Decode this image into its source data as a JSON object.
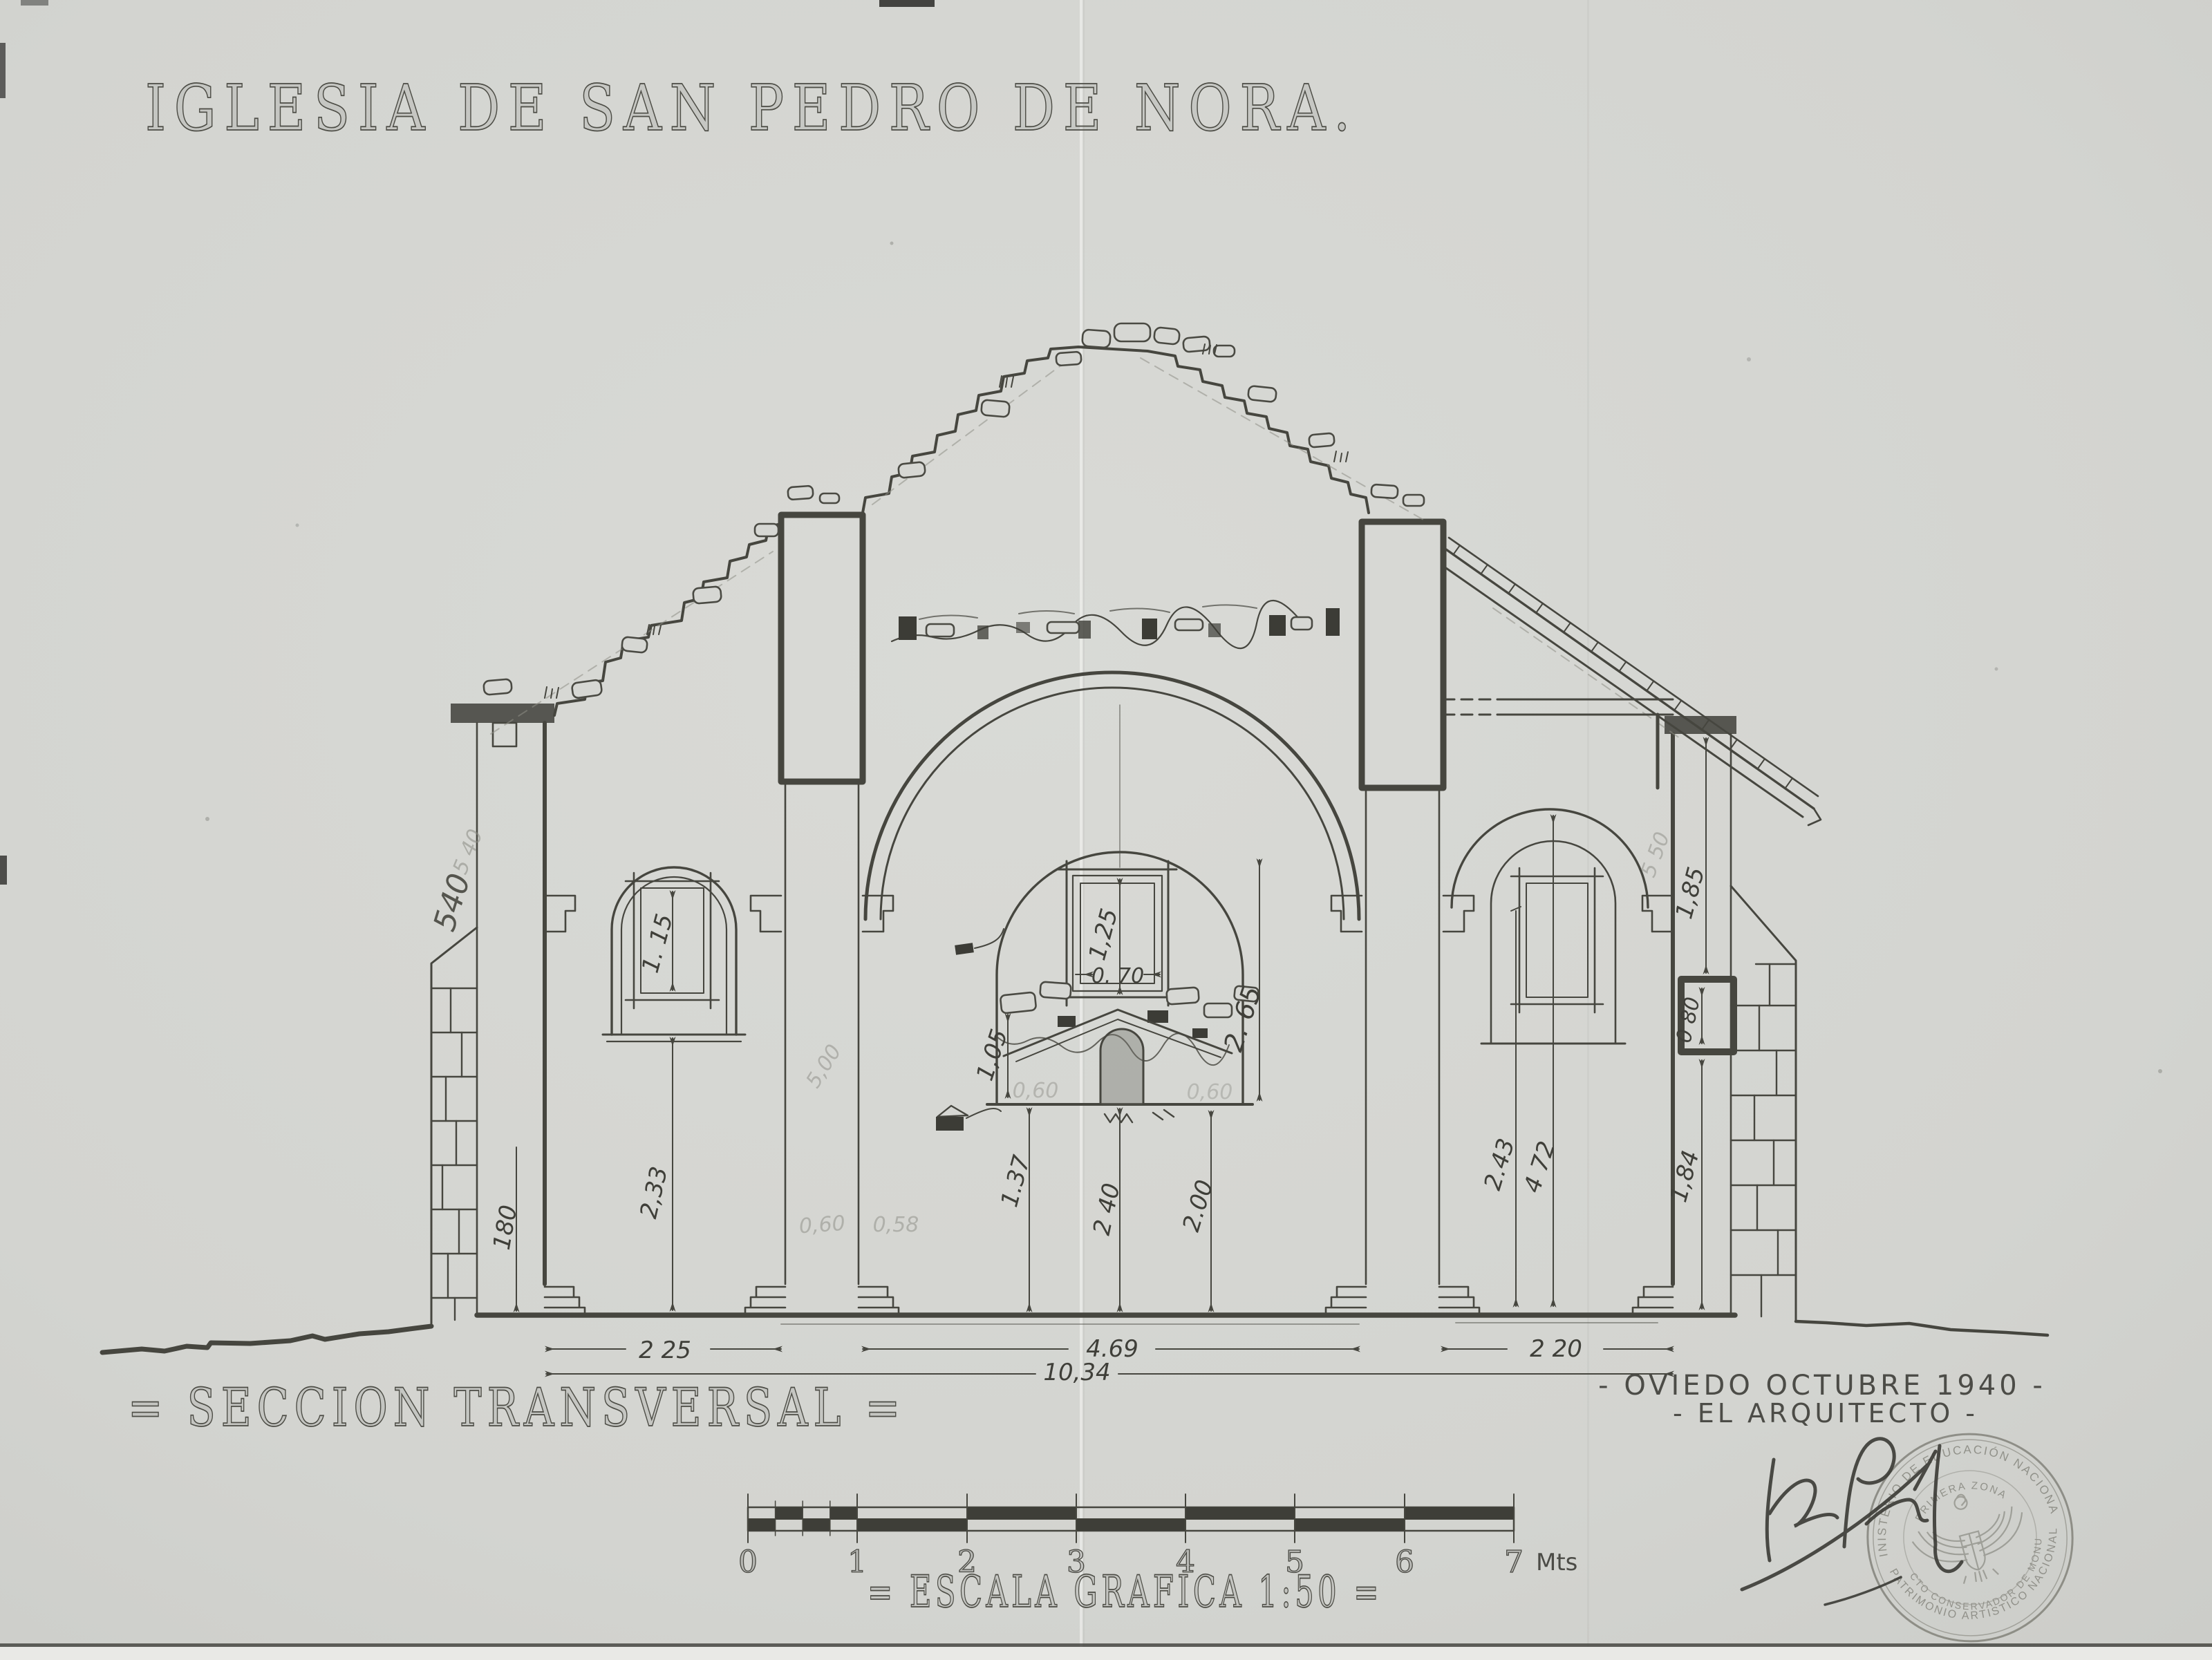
{
  "title": "IGLESIA DE SAN PEDRO DE NORA.",
  "section_label": "= SECCION TRANSVERSAL =",
  "credit": {
    "place_date": "- OVIEDO  OCTUBRE  1940 -",
    "architect": "- EL ARQUITECTO -"
  },
  "scale_bar": {
    "label": "= ESCALA GRAFICA 1:50 =",
    "unit": "Mts",
    "ticks": [
      "0",
      "1",
      "2",
      "3",
      "4",
      "5",
      "6",
      "7"
    ]
  },
  "stamp": {
    "arc_top": "MINISTERIO DE EDUCACIÓN NACIONAL",
    "arc_inner": "PRIMERA ZONA",
    "arc_mid": "ARQUITECTO CONSERVADOR DE MONUMENTOS",
    "arc_bottom": "PATRIMONIO ARTISTICO NACIONAL"
  },
  "dimensions": {
    "bay_left": "2 25",
    "nave_span": "4.69",
    "bay_right": "2 20",
    "total_width": "10,34",
    "left_wall_pencil_a": "540",
    "left_wall_pencil_b": "5 40",
    "left_wall_base": "180",
    "left_window_height": "1. 15",
    "left_sill_height": "2,33",
    "niche_upper": "1,05",
    "altar_left": "1.37",
    "altar_center": "2 40",
    "altar_right": "2.00",
    "nave_window_height": "1,25",
    "nave_window_width": "0. 70",
    "nave_arch_height": "2. 65",
    "right_springing": "2.43",
    "right_arch_height": "4 72",
    "right_wall_upper": "1,85",
    "right_wall_window": "0 80",
    "right_wall_lower": "1,84",
    "right_wall_pencil": "5 50"
  },
  "pencil_notes": {
    "a": "5,00",
    "b": "0,60",
    "c": "0,58",
    "d": "0,60",
    "e": "0,60"
  }
}
